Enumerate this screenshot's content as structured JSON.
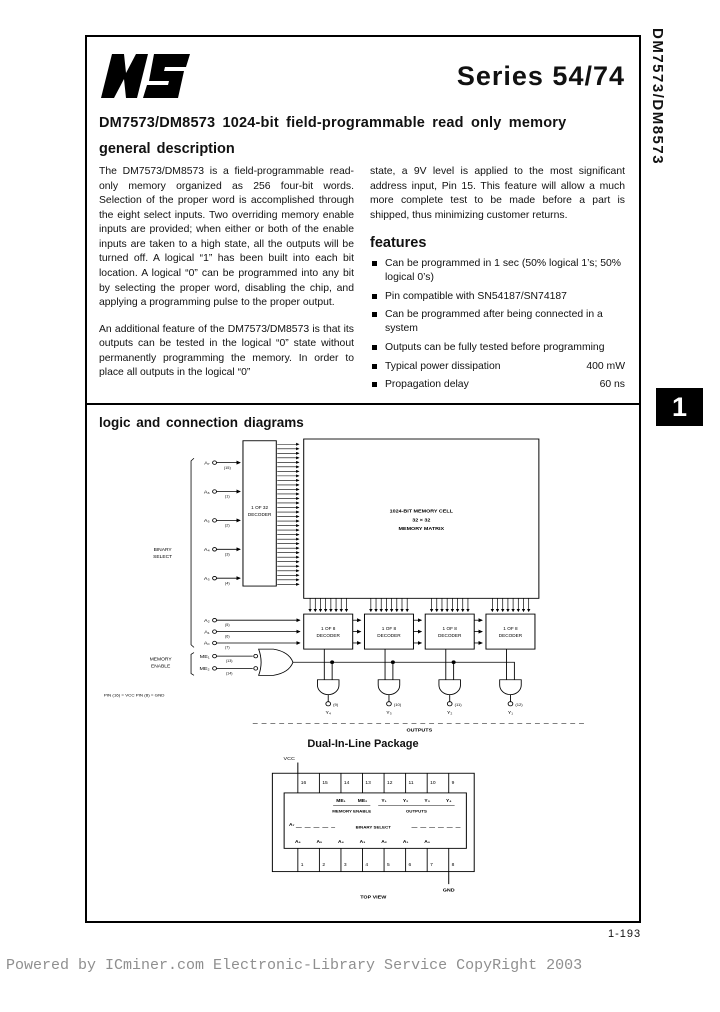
{
  "page": {
    "series_title": "Series 54/74",
    "part_title": "DM7573/DM8573 1024-bit field-programmable read only memory",
    "general_description_heading": "general description",
    "side_tab_label": "DM7573/DM8573",
    "section_tab_number": "1",
    "page_number": "1-193",
    "watermark": "Powered by ICminer.com Electronic-Library Service CopyRight 2003"
  },
  "description": {
    "col1_p1": "The DM7573/DM8573 is a field-programmable read-only memory organized as 256 four-bit words. Selection of the proper word is accomplished through the eight select inputs. Two overriding memory enable inputs are provided; when either or both of the enable inputs are taken to a high state, all the outputs will be turned off. A logical “1” has been built into each bit location. A logical “0” can be programmed into any bit by selecting the proper word, disabling the chip, and applying a programming pulse to the proper output.",
    "col1_p2": "An additional feature of the DM7573/DM8573 is that its outputs can be tested in the logical “0” state without permanently programming the memory. In order to place all outputs in the logical “0”",
    "col2_p1": "state, a 9V level is applied to the most significant address input, Pin 15. This feature will allow a much more complete test to be made before a part is shipped, thus minimizing customer returns."
  },
  "features": {
    "heading": "features",
    "items": [
      {
        "text": "Can be programmed in 1 sec (50% logical 1’s; 50% logical 0’s)",
        "value": ""
      },
      {
        "text": "Pin compatible with SN54187/SN74187",
        "value": ""
      },
      {
        "text": "Can be programmed after being connected in a system",
        "value": ""
      },
      {
        "text": "Outputs can be fully tested before programming",
        "value": ""
      },
      {
        "text": "Typical power dissipation",
        "value": "400 mW"
      },
      {
        "text": "Propagation delay",
        "value": "60 ns"
      }
    ]
  },
  "diagrams": {
    "heading": "logic and connection diagrams",
    "logic": {
      "decoder32_l1": "1 OF 32",
      "decoder32_l2": "DECODER",
      "memory_l1": "1024-BIT MEMORY CELL",
      "memory_l2": "32 × 32",
      "memory_l3": "MEMORY MATRIX",
      "binary_select_l1": "BINARY",
      "binary_select_l2": "SELECT",
      "enable_label_l1": "MEMORY",
      "enable_label_l2": "ENABLE",
      "decoder8_l1": "1 OF 8",
      "decoder8_l2": "DECODER",
      "outputs_label": "OUTPUTS",
      "note": "PIN (16) = VCC   PIN (8) = GND",
      "row_inputs": [
        {
          "name": "A₇",
          "pin": "(15)"
        },
        {
          "name": "A₆",
          "pin": "(1)"
        },
        {
          "name": "A₅",
          "pin": "(2)"
        },
        {
          "name": "A₄",
          "pin": "(3)"
        },
        {
          "name": "A₃",
          "pin": "(4)"
        }
      ],
      "col_inputs": [
        {
          "name": "A₂",
          "pin": "(5)"
        },
        {
          "name": "A₁",
          "pin": "(6)"
        },
        {
          "name": "A₀",
          "pin": "(7)"
        }
      ],
      "enable_inputs": [
        {
          "name": "ME₁",
          "pin": "(13)"
        },
        {
          "name": "ME₂",
          "pin": "(14)"
        }
      ],
      "outputs": [
        {
          "name": "Y₄",
          "pin": "(9)"
        },
        {
          "name": "Y₃",
          "pin": "(10)"
        },
        {
          "name": "Y₂",
          "pin": "(11)"
        },
        {
          "name": "Y₁",
          "pin": "(12)"
        }
      ]
    },
    "dip": {
      "title": "Dual-In-Line Package",
      "vcc": "VCC",
      "gnd": "GND",
      "top_view": "TOP VIEW",
      "memory_enable_label": "MEMORY ENABLE",
      "outputs_label": "OUTPUTS",
      "a7_label": "A₇",
      "binary_select_label": "BINARY SELECT",
      "top_pins": [
        "16",
        "15",
        "14",
        "13",
        "12",
        "11",
        "10",
        "9"
      ],
      "bottom_pins": [
        "1",
        "2",
        "3",
        "4",
        "5",
        "6",
        "7",
        "8"
      ],
      "inner_top": [
        "ME₁",
        "ME₂",
        "Y₁",
        "Y₂",
        "Y₃",
        "Y₄"
      ],
      "inner_bottom": [
        "A₆",
        "A₅",
        "A₄",
        "A₃",
        "A₂",
        "A₁",
        "A₀"
      ]
    }
  }
}
